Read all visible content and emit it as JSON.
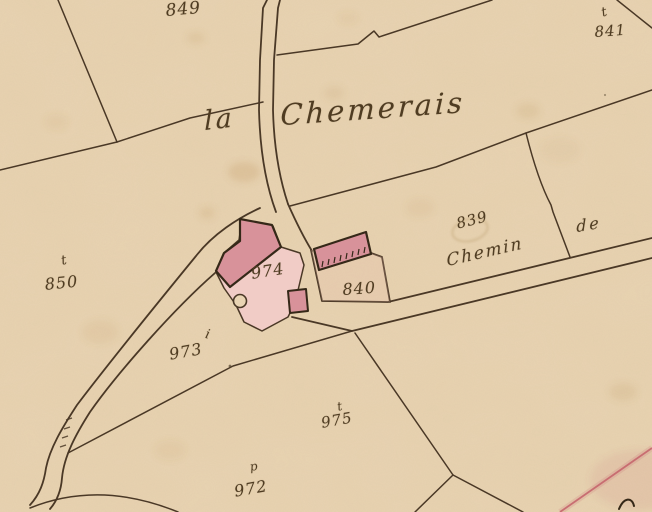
{
  "map": {
    "place": {
      "article": "la",
      "name": "Chemerais"
    },
    "road": {
      "word1": "Chemin",
      "word2": "de"
    },
    "parcels": [
      {
        "number": "849",
        "landuse_symbol": ""
      },
      {
        "number": "841",
        "landuse_symbol": "t"
      },
      {
        "number": "850",
        "landuse_symbol": "t"
      },
      {
        "number": "839",
        "landuse_symbol": ""
      },
      {
        "number": "840",
        "landuse_symbol": ""
      },
      {
        "number": "974",
        "landuse_symbol": ""
      },
      {
        "number": "973",
        "landuse_symbol": "i"
      },
      {
        "number": "975",
        "landuse_symbol": "t"
      },
      {
        "number": "972",
        "landuse_symbol": "p"
      }
    ],
    "colors": {
      "paper": "#e9d4b3",
      "ink": "#4a3826",
      "ink_dark": "#352818",
      "ink_text": "#4f3c22",
      "building_fill": "#d8929a",
      "courtyard_fill": "#f1ccc6",
      "enclosure_wash": "#e8b9ae",
      "red_line": "#c4606a",
      "stain": "#b98d52"
    }
  }
}
